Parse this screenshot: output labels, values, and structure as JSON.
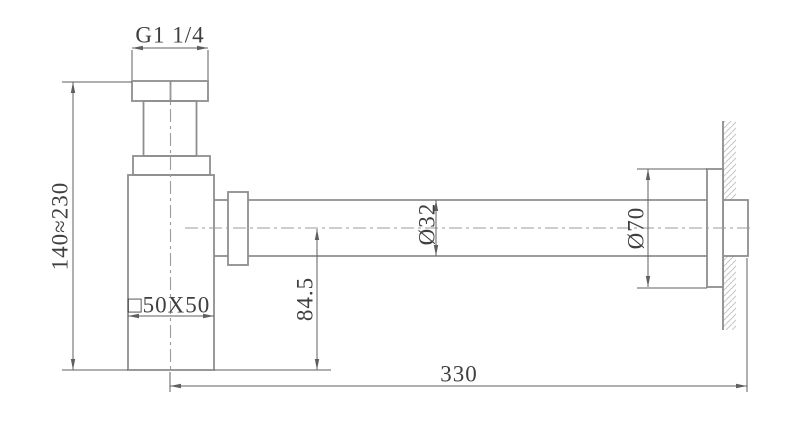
{
  "drawing": {
    "kind": "technical-dimension-drawing",
    "subject": "square bottle trap with wall outlet pipe",
    "labels": {
      "thread_size": "G1 1/4",
      "adjustable_height": "140≈230",
      "body_section": "□50X50",
      "outlet_centre_height": "84.5",
      "pipe_diameter": "Ø32",
      "flange_diameter": "Ø70",
      "wall_reach": "330"
    },
    "colors": {
      "background": "#ffffff",
      "geometry_line": "#8e8e8e",
      "dimension_line": "#5f5f5f",
      "text": "#3f3f3f",
      "hatch": "#c6c6c6",
      "centerline": "#9b9b9b"
    }
  }
}
